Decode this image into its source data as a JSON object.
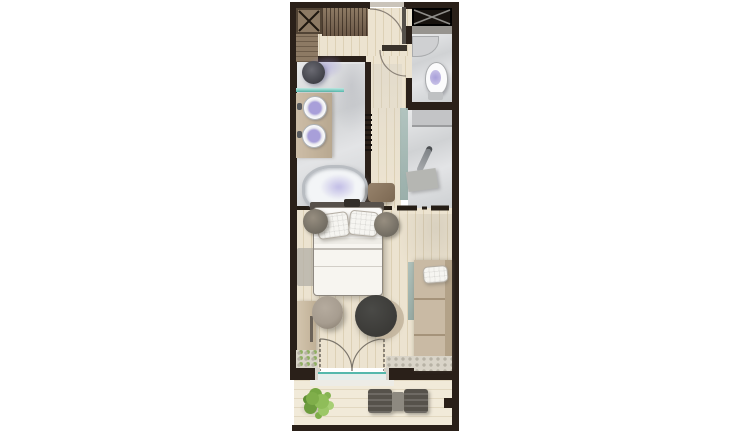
{
  "palette": {
    "wall": "#2a2019",
    "floor_wood": "#ece3d0",
    "floor_wood_line": "#ddd1b6",
    "marble_light": "#e9eaeb",
    "marble_dark": "#d0d2d4",
    "deck": "#f1ead9",
    "deck_line": "#e2d8c1",
    "wood_dark": "#6b5847",
    "wood_mid": "#8d7a64",
    "glass_teal": "#54b8ac",
    "glass_grey": "#8fa6a1",
    "fixture_rim": "#aeb3b8",
    "water_lavender": "#a89fd9",
    "textile": "#f6f5f1",
    "sofa": "#c9baa4",
    "sofa_line": "#a5937a",
    "charcoal": "#3b3a37",
    "pouf": "#a79d90",
    "rug": "#b6b1a9",
    "leaf_green": "#7fae4a",
    "chair_dark": "#56524b",
    "arc_line": "#8a8177"
  },
  "labels": {
    "plan": "Hotel room floor plan",
    "entry": "Entry hall",
    "wardrobe": "Wardrobe cabinet",
    "hanging_rail": "Wardrobe hanging rail",
    "dresser": "Dresser",
    "entry_door": "Entry door",
    "inner_door": "Bathroom door",
    "closet": "Closet",
    "rain_shower": "Rain shower head",
    "glass_shelf": "Glass shower screen",
    "vanity": "Vanity with two round basins",
    "bathtub": "Freestanding bathtub",
    "tub_stool": "Bath stool",
    "towel_radiator": "Towel radiator",
    "wc_sink": "Corner hand basin",
    "toilet": "Toilet",
    "shower_room": "Walk-in shower",
    "shower_glass": "Shower glass panel",
    "shower_ledge": "Shower ledge",
    "hand_shower": "Hand shower",
    "shower_bench": "Shower bench",
    "partition": "Sliding partition",
    "headboard": "Headboard",
    "bed": "Double bed",
    "pillow": "Pillow",
    "bedside": "Bedside stool",
    "rug": "Rug",
    "console": "Console cabinet",
    "pouf": "Pouf",
    "coffee_table": "Round coffee table",
    "daybed": "Daybed chaise",
    "french_doors": "French doors to balcony",
    "planter": "Pebble planter strip",
    "balcony": "Balcony deck",
    "plant": "Potted plant",
    "balcony_chair": "Balcony chair",
    "balcony_table": "Balcony side table",
    "railing": "Balcony railing"
  }
}
